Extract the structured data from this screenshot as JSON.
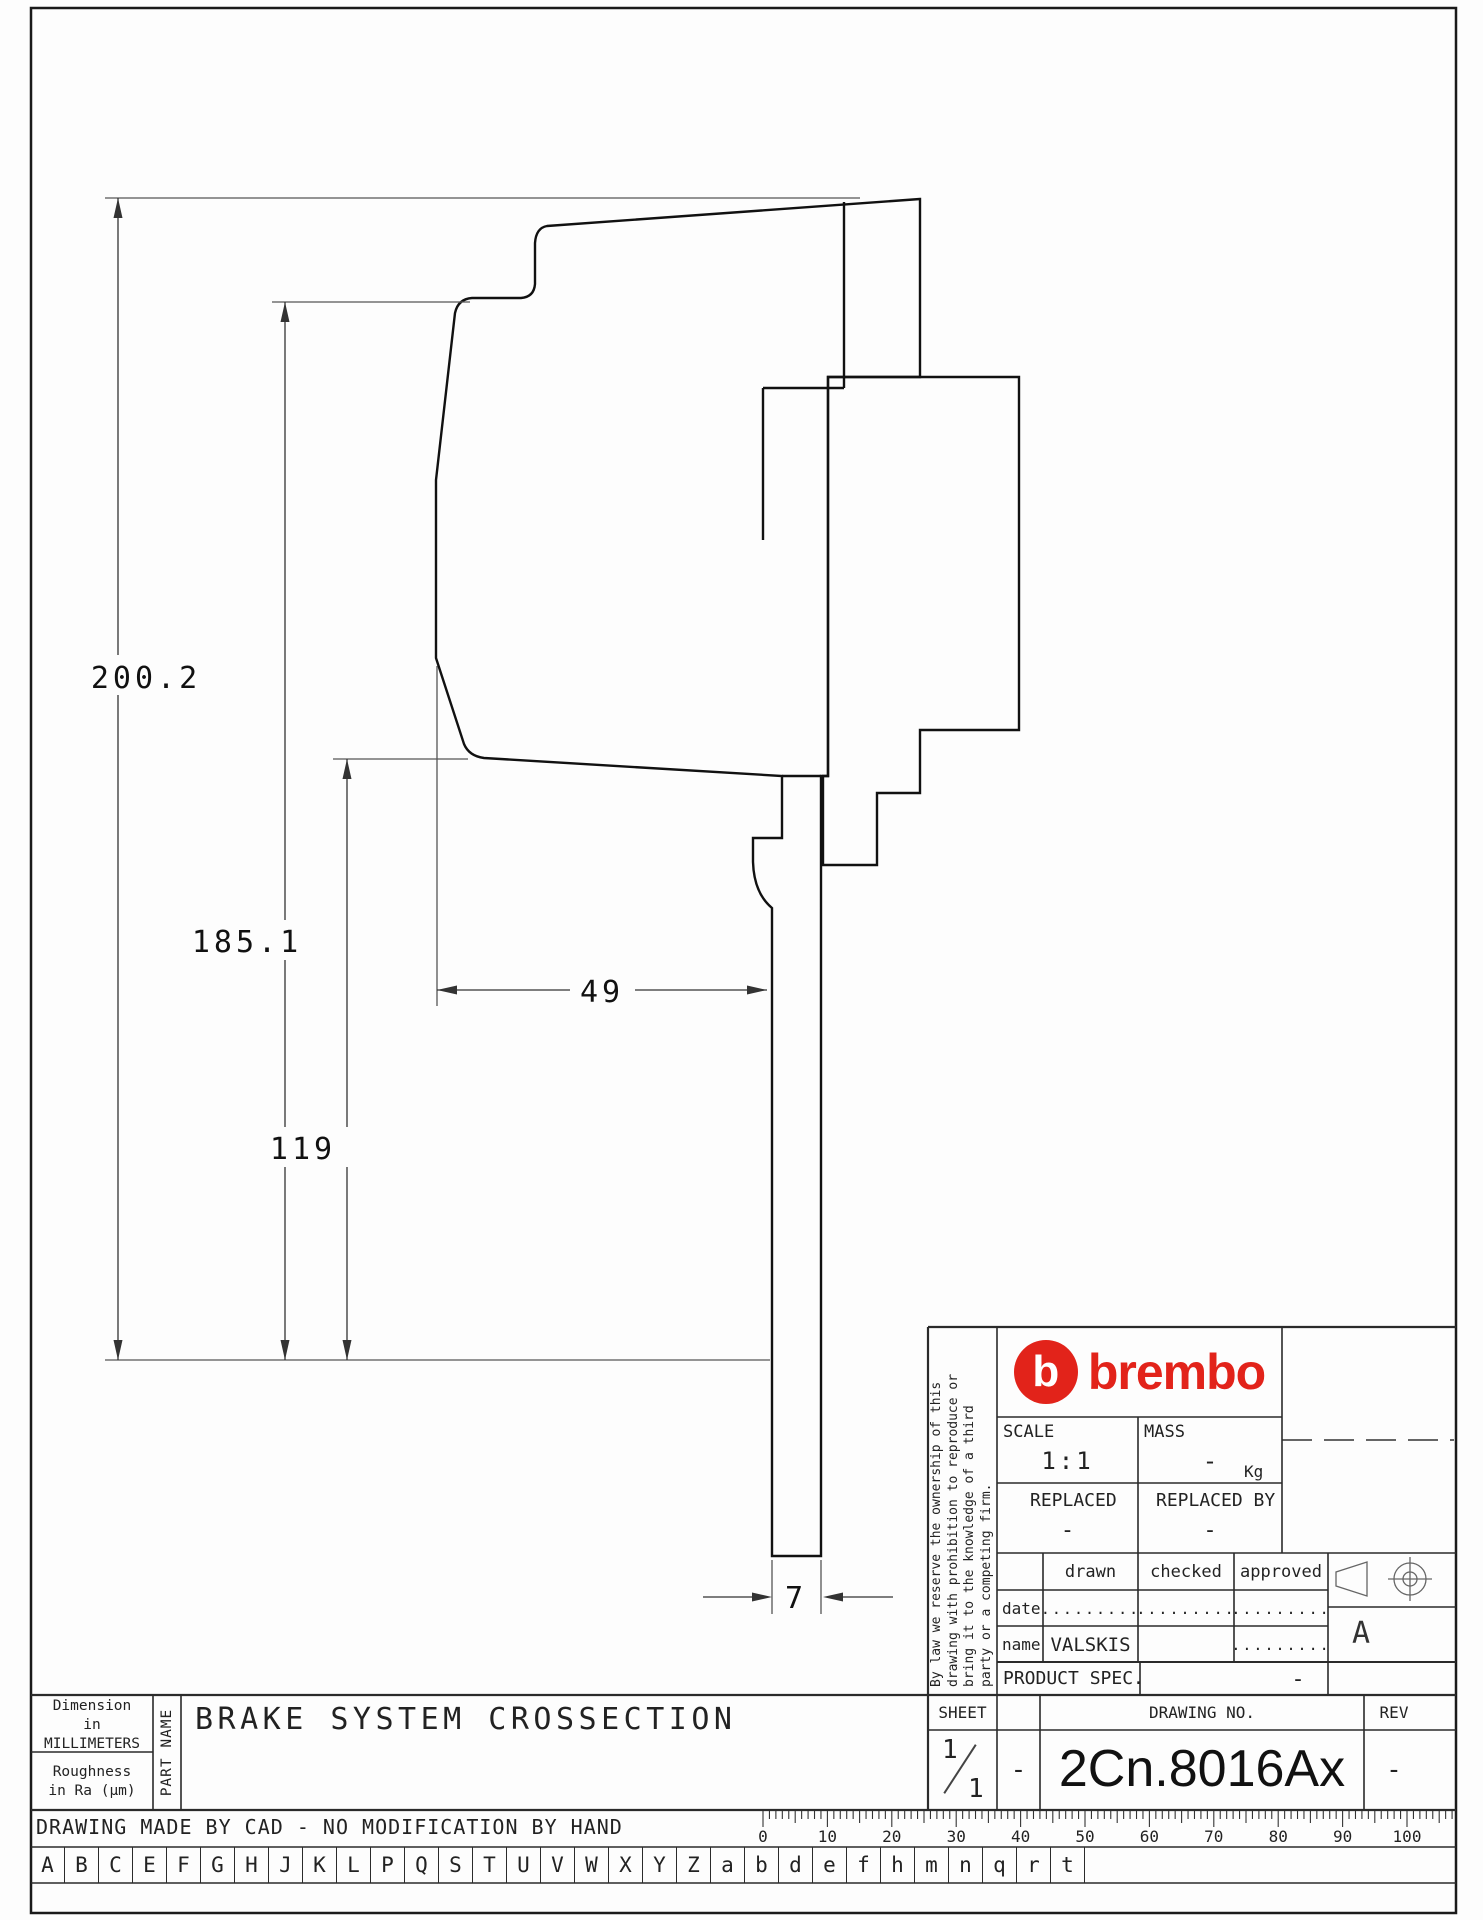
{
  "drawing": {
    "dim_total_height": "200.2",
    "dim_mid_height": "185.1",
    "dim_lower_height": "119",
    "dim_pad_width": "49",
    "dim_disc_thickness": "7"
  },
  "title_block": {
    "brand": "brembo",
    "brand_initial": "b",
    "brand_color": "#e2231a",
    "scale_label": "SCALE",
    "scale_value": "1:1",
    "mass_label": "MASS",
    "mass_value": "-",
    "mass_unit": "Kg",
    "replaced_label": "REPLACED",
    "replaced_value": "-",
    "replaced_by_label": "REPLACED BY",
    "replaced_by_value": "-",
    "col_drawn": "drawn",
    "col_checked": "checked",
    "col_approved": "approved",
    "row_date": "date",
    "row_name": "name",
    "dots": ".........",
    "name_drawn": "VALSKIS",
    "product_spec_label": "PRODUCT SPEC.",
    "product_spec_value": "-",
    "sheet_label": "SHEET",
    "sheet_numerator": "1",
    "sheet_denominator": "1",
    "sheet_adjacent_value": "-",
    "drawing_no_label": "DRAWING NO.",
    "drawing_no": "2Cn.8016Ax",
    "rev_label": "REV",
    "rev_value": "-",
    "format_letter": "A",
    "legal_lines": [
      "By law we reserve the ownership of this",
      "drawing with prohibition to reproduce or",
      "bring it to the knowledge of a third",
      "party or a competing firm."
    ]
  },
  "footer": {
    "dimension_note_l1": "Dimension",
    "dimension_note_l2": "in MILLIMETERS",
    "roughness_note_l1": "Roughness",
    "roughness_note_l2": "in Ra (μm)",
    "part_name_label": "PART NAME",
    "part_title": "BRAKE SYSTEM CROSSECTION",
    "cad_note": "DRAWING MADE BY CAD - NO MODIFICATION BY HAND",
    "ruler_numbers": [
      0,
      10,
      20,
      30,
      40,
      50,
      60,
      70,
      80,
      90,
      100
    ],
    "letters": [
      "A",
      "B",
      "C",
      "E",
      "F",
      "G",
      "H",
      "J",
      "K",
      "L",
      "P",
      "Q",
      "S",
      "T",
      "U",
      "V",
      "W",
      "X",
      "Y",
      "Z",
      "a",
      "b",
      "d",
      "e",
      "f",
      "h",
      "m",
      "n",
      "q",
      "r",
      "t"
    ]
  }
}
